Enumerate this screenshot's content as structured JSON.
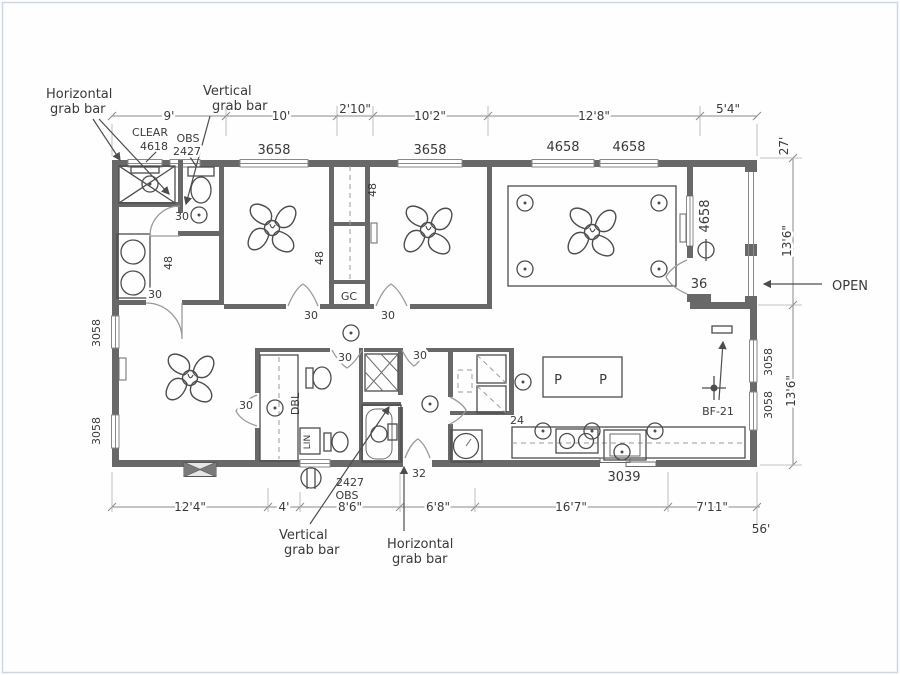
{
  "colors": {
    "wall": "#686868",
    "ink": "#3a3a3a",
    "fixture_line": "#4d4d4d",
    "dim_line": "#8b8b8b",
    "scan_border": "#ccd8e4"
  },
  "annotations": {
    "horizontal_grab_bar_top": [
      "Horizontal",
      "grab bar"
    ],
    "vertical_grab_bar_top": [
      "Vertical",
      "grab bar"
    ],
    "clear_window": [
      "CLEAR",
      "4618"
    ],
    "obs_window_top": [
      "OBS",
      "2427"
    ],
    "obs_window_bottom": [
      "2427",
      "OBS"
    ],
    "vertical_grab_bar_bottom": [
      "Vertical",
      "grab bar"
    ],
    "horizontal_grab_bar_bottom": [
      "Horizontal",
      "grab bar"
    ],
    "open": "OPEN",
    "bath_fan": "BF-21"
  },
  "dimensions": {
    "top": [
      "9'",
      "10'",
      "2'10\"",
      "10'2\"",
      "12'8\"",
      "5'4\""
    ],
    "bottom": [
      "12'4\"",
      "4'",
      "8'6\"",
      "6'8\"",
      "16'7\"",
      "7'11\""
    ],
    "overall_width": "56'",
    "overall_depth": "27'",
    "porch_section_depth": "13'6\"",
    "rear_section_depth": "13'6\""
  },
  "window_sizes": {
    "top": [
      "3658",
      "3658",
      "4658",
      "4658"
    ],
    "porch_wall": "4658",
    "left": [
      "3058",
      "3058"
    ],
    "right": [
      "3058",
      "3058"
    ]
  },
  "door_sizes": {
    "standard": "30",
    "porch_door": "36",
    "bath_door": "32",
    "patio_slider": "3039",
    "counter_depth": "24"
  },
  "room_labels": {
    "garment_closet": "GC",
    "linen": "LIN",
    "double_vanity": "DBL",
    "pantry": "P",
    "closet_depth": "48"
  }
}
